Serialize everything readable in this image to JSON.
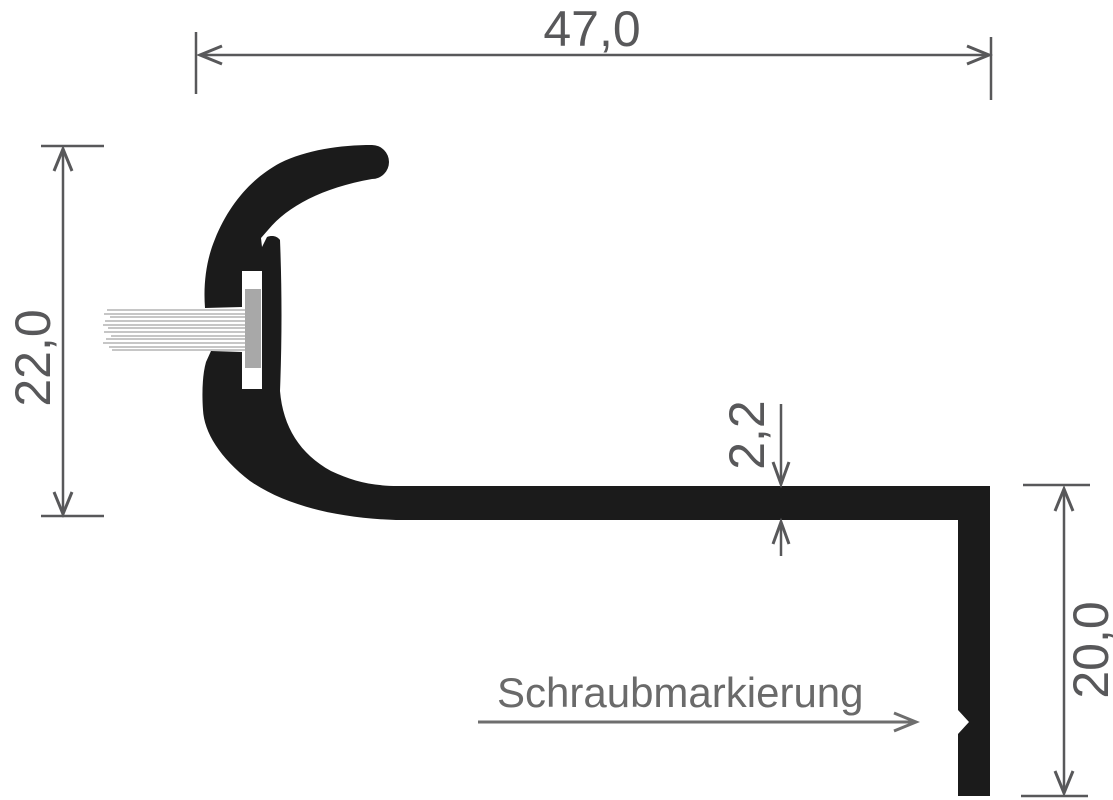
{
  "diagram": {
    "type": "technical-profile-cross-section",
    "dimensions": {
      "top_width": "47,0",
      "left_height": "22,0",
      "tread_thickness": "2,2",
      "right_drop": "20,0"
    },
    "annotation": {
      "screw_marking_label": "Schraubmarkierung"
    },
    "colors": {
      "profile": "#1b1b1b",
      "dimension": "#58585a",
      "annotation_text": "#6a6a6a",
      "bristles": "#c6c6c6",
      "brush_holder": "#a8a8a8",
      "background": "#ffffff"
    }
  }
}
